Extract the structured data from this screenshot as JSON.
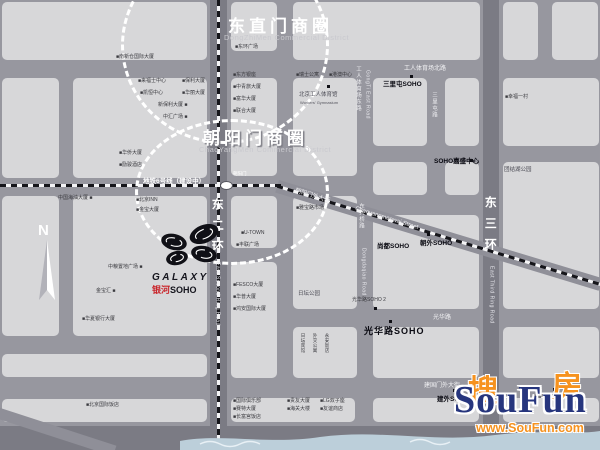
{
  "map": {
    "background": "#97979f",
    "block_color": "#d7d7d9",
    "ring_color": "#7b7b84",
    "accent_red": "#c9252b",
    "blocks": [
      [
        2,
        2,
        205,
        58
      ],
      [
        2,
        78,
        57,
        100
      ],
      [
        73,
        78,
        134,
        100
      ],
      [
        2,
        196,
        57,
        140
      ],
      [
        73,
        196,
        134,
        140
      ],
      [
        2,
        354,
        205,
        23
      ],
      [
        2,
        399,
        205,
        23
      ],
      [
        231,
        2,
        46,
        49
      ],
      [
        293,
        2,
        187,
        58
      ],
      [
        503,
        2,
        35,
        58
      ],
      [
        552,
        2,
        46,
        58
      ],
      [
        231,
        78,
        46,
        98
      ],
      [
        293,
        78,
        64,
        98
      ],
      [
        373,
        78,
        54,
        68
      ],
      [
        445,
        78,
        34,
        68
      ],
      [
        503,
        78,
        96,
        68
      ],
      [
        373,
        162,
        54,
        33
      ],
      [
        445,
        162,
        34,
        33
      ],
      [
        503,
        162,
        96,
        147
      ],
      [
        231,
        196,
        46,
        52
      ],
      [
        293,
        196,
        64,
        113
      ],
      [
        231,
        262,
        46,
        116
      ],
      [
        373,
        215,
        106,
        94
      ],
      [
        293,
        327,
        64,
        51
      ],
      [
        373,
        327,
        106,
        51
      ],
      [
        503,
        327,
        96,
        51
      ],
      [
        231,
        398,
        124,
        24
      ],
      [
        373,
        398,
        106,
        24
      ],
      [
        503,
        398,
        96,
        24
      ]
    ],
    "dark_roads": [
      [
        210,
        0,
        17,
        450
      ],
      [
        483,
        0,
        16,
        450
      ],
      [
        0,
        426,
        600,
        24
      ]
    ],
    "diagonals": [
      {
        "x": 279,
        "y": 180,
        "len": 338,
        "h": 13,
        "rot": 16.9,
        "dash": true
      },
      {
        "x": -12,
        "y": 404,
        "len": 135,
        "h": 11,
        "rot": 18,
        "dash": false
      }
    ],
    "dashes": [
      {
        "type": "v",
        "x": 217,
        "y": 0,
        "len": 450
      },
      {
        "type": "h",
        "x": 0,
        "y": 184,
        "len": 281
      }
    ],
    "station": {
      "x": 220,
      "y": 181
    },
    "districts": [
      {
        "title": "东直门商圈",
        "subtitle": "DongZhiMen Commercial District",
        "cx": 225,
        "cy": 45,
        "rx": 104,
        "ry": 99,
        "tx": 228,
        "ty": 12,
        "shadow": false
      },
      {
        "title": "朝阳门商圈",
        "subtitle": "ChaoYangMen Commercial District",
        "cx": 232,
        "cy": 192,
        "rx": 97,
        "ry": 73,
        "tx": 203,
        "ty": 124,
        "shadow": true
      }
    ],
    "labels": [
      [
        "工人体育场北路",
        404,
        66,
        "r"
      ],
      [
        "地铁6号线（建设中）",
        143,
        178,
        "rb"
      ],
      [
        "朝阳门外大街",
        296,
        188,
        "r",
        17
      ],
      [
        "Chaoyangmenwai Street",
        356,
        206,
        "r",
        17
      ],
      [
        "建国门外大街",
        424,
        383,
        "r"
      ],
      [
        "光华路",
        433,
        315,
        "r"
      ],
      [
        "朝阳门",
        233,
        172,
        "rt"
      ],
      [
        "东二环",
        210,
        198,
        "vb"
      ],
      [
        "East Second Ring Road",
        214,
        262,
        "ve"
      ],
      [
        "东三环",
        483,
        196,
        "vb"
      ],
      [
        "East Third Ring Road",
        488,
        266,
        "ve"
      ],
      [
        "工人体育场东路",
        355,
        66,
        "v"
      ],
      [
        "GongTi East Road",
        364,
        70,
        "ve"
      ],
      [
        "东大桥路",
        358,
        203,
        "v"
      ],
      [
        "Dongdaqiao Road",
        360,
        248,
        "ve"
      ],
      [
        "三里屯路",
        431,
        92,
        "v"
      ],
      [
        "三里屯SOHO",
        383,
        81,
        "bb"
      ],
      [
        "SOHO嘉盛中心",
        434,
        158,
        "bb"
      ],
      [
        "尚都SOHO",
        377,
        243,
        "bb"
      ],
      [
        "朝外SOHO",
        420,
        240,
        "bb"
      ],
      [
        "光华路SOHO 2",
        352,
        298,
        "b"
      ],
      [
        "光华路SOHO",
        364,
        327,
        "big"
      ],
      [
        "建外SOHO",
        437,
        396,
        "bb"
      ],
      [
        "日坛公园",
        298,
        291,
        "g"
      ],
      [
        "团结湖公园",
        504,
        167,
        "g"
      ],
      [
        "北京工人体育馆",
        299,
        92,
        "g"
      ],
      [
        "Workers' Gymnasium",
        300,
        101,
        "tiny"
      ],
      [
        "■幸福一村",
        505,
        95,
        "b"
      ],
      [
        "■南新仓国际大厦",
        116,
        55,
        "b"
      ],
      [
        "■来福士中心",
        138,
        79,
        "b"
      ],
      [
        "■保利大厦",
        182,
        79,
        "b"
      ],
      [
        "■凯恒中心",
        140,
        91,
        "b"
      ],
      [
        "■华丽大厦",
        182,
        91,
        "b"
      ],
      [
        "新保利大厦 ■",
        158,
        103,
        "b"
      ],
      [
        "中汇广场 ■",
        163,
        115,
        "b"
      ],
      [
        "■华侨大厦",
        119,
        151,
        "b"
      ],
      [
        "■励骏酒店",
        119,
        163,
        "b"
      ],
      [
        "中国海油大厦 ■",
        58,
        196,
        "b"
      ],
      [
        "■北京INN",
        136,
        198,
        "b"
      ],
      [
        "■金宝大厦",
        136,
        208,
        "b"
      ],
      [
        "中粮置地广场 ■",
        108,
        265,
        "b"
      ],
      [
        "金宝汇 ■",
        96,
        289,
        "b"
      ],
      [
        "■华夏银行大厦",
        82,
        317,
        "b"
      ],
      [
        "■北京国际饭店",
        86,
        403,
        "b"
      ],
      [
        "■东环广场",
        235,
        45,
        "b"
      ],
      [
        "■东方银座",
        233,
        73,
        "b"
      ],
      [
        "■中青旅大厦",
        233,
        85,
        "b"
      ],
      [
        "■富华大厦",
        233,
        97,
        "b"
      ],
      [
        "■联合大厦",
        233,
        109,
        "b"
      ],
      [
        "■瑞士公寓",
        296,
        73,
        "b"
      ],
      [
        "■港澳中心",
        329,
        73,
        "b"
      ],
      [
        "■U-TOWN",
        241,
        231,
        "b"
      ],
      [
        "■丰联广场",
        236,
        243,
        "b"
      ],
      [
        "■雅宝路市场",
        296,
        206,
        "b"
      ],
      [
        "■FESCO大厦",
        233,
        283,
        "b"
      ],
      [
        "■华普大厦",
        233,
        295,
        "b"
      ],
      [
        "■鸿安国际大厦",
        233,
        307,
        "b"
      ],
      [
        "日坛宾馆",
        300,
        333,
        "vt"
      ],
      [
        "外交公寓",
        312,
        333,
        "vt"
      ],
      [
        "永安饭店",
        324,
        333,
        "vt"
      ],
      [
        "■国际俱乐部",
        233,
        399,
        "b"
      ],
      [
        "■赛特大厦",
        233,
        407,
        "b"
      ],
      [
        "■长富宫饭店",
        233,
        415,
        "b"
      ],
      [
        "■贵友大厦",
        287,
        399,
        "b"
      ],
      [
        "■海关大楼",
        287,
        407,
        "b"
      ],
      [
        "■LG双子座",
        320,
        399,
        "b"
      ],
      [
        "■友谊商店",
        320,
        407,
        "b"
      ],
      [
        "■国贸中心",
        535,
        394,
        "b"
      ]
    ],
    "dots": [
      [
        410,
        75
      ],
      [
        470,
        159
      ],
      [
        427,
        233
      ],
      [
        374,
        307
      ],
      [
        389,
        320
      ],
      [
        453,
        389
      ],
      [
        327,
        85
      ],
      [
        553,
        388
      ]
    ]
  },
  "compass": {
    "label": "N"
  },
  "galaxy_logo": {
    "name": "GALAXY",
    "cn_red": "银河",
    "cn_black": "SOHO"
  },
  "watermark": {
    "zh1": "搜",
    "zh2": "房",
    "en": "SouFun",
    "url": "www.SouFun.com"
  }
}
